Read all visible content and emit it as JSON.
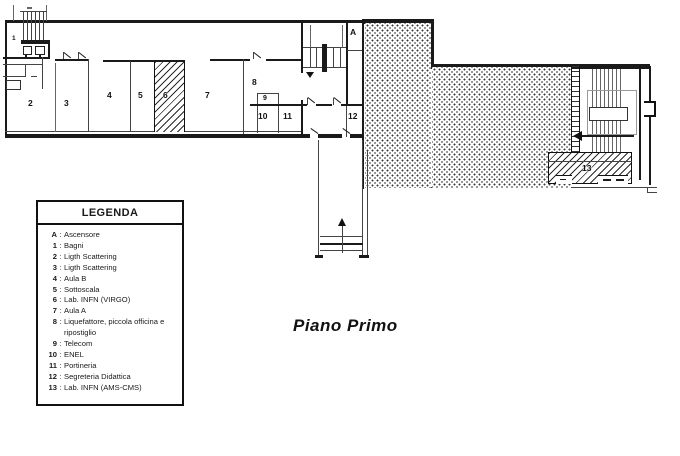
{
  "title": "Piano Primo",
  "legend": {
    "title": "LEGENDA",
    "separator": ":",
    "items": [
      {
        "key": "A",
        "label": "Ascensore"
      },
      {
        "key": "1",
        "label": "Bagni"
      },
      {
        "key": "2",
        "label": "Ligth Scattering"
      },
      {
        "key": "3",
        "label": "Ligth Scattering"
      },
      {
        "key": "4",
        "label": "Aula B"
      },
      {
        "key": "5",
        "label": "Sottoscala"
      },
      {
        "key": "6",
        "label": "Lab. INFN (VIRGO)"
      },
      {
        "key": "7",
        "label": "Aula A"
      },
      {
        "key": "8",
        "label": "Liquefattore, piccola officina e ripostiglio"
      },
      {
        "key": "9",
        "label": "Telecom"
      },
      {
        "key": "10",
        "label": "ENEL"
      },
      {
        "key": "11",
        "label": "Portineria"
      },
      {
        "key": "12",
        "label": "Segreteria Didattica"
      },
      {
        "key": "13",
        "label": "Lab. INFN (AMS-CMS)"
      }
    ]
  },
  "plan": {
    "room_labels": [
      "A",
      "1",
      "2",
      "3",
      "4",
      "5",
      "6",
      "7",
      "8",
      "9",
      "10",
      "11",
      "12",
      "13"
    ]
  },
  "colors": {
    "ink": "#1a1a1a",
    "paper": "#ffffff"
  }
}
